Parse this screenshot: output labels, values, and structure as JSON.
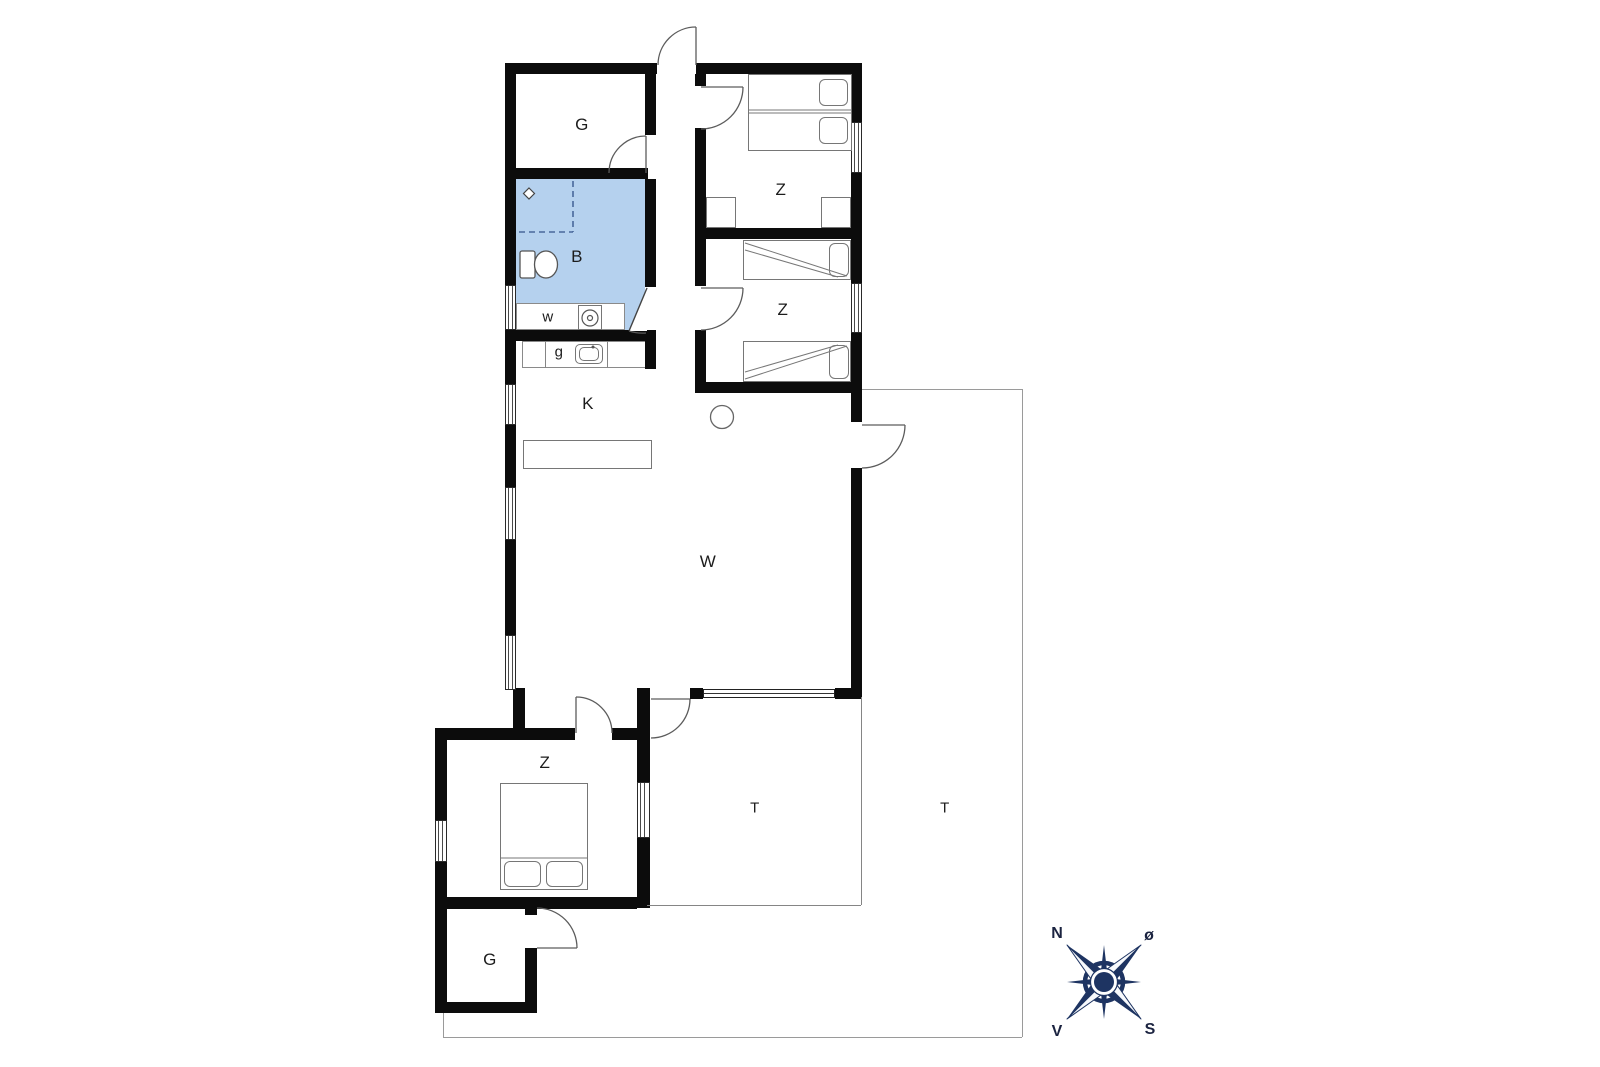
{
  "rooms": [
    {
      "id": "storage-top",
      "label": "G"
    },
    {
      "id": "bedroom-1",
      "label": "Z"
    },
    {
      "id": "bathroom",
      "label": "B"
    },
    {
      "id": "utility",
      "label": "w"
    },
    {
      "id": "guest-wc",
      "label": "g"
    },
    {
      "id": "kitchen",
      "label": "K"
    },
    {
      "id": "bedroom-2",
      "label": "Z"
    },
    {
      "id": "living-room",
      "label": "W"
    },
    {
      "id": "bedroom-3",
      "label": "Z"
    },
    {
      "id": "storage-bottom",
      "label": "G"
    },
    {
      "id": "terrace-covered",
      "label": "T"
    },
    {
      "id": "terrace-open",
      "label": "T"
    }
  ],
  "compass": {
    "north": "N",
    "east": "ø",
    "south": "S",
    "west": "V"
  },
  "colors": {
    "bathroom_fill": "#b5d1ee",
    "wall": "#0c0c0c",
    "compass_navy": "#1e3462"
  }
}
